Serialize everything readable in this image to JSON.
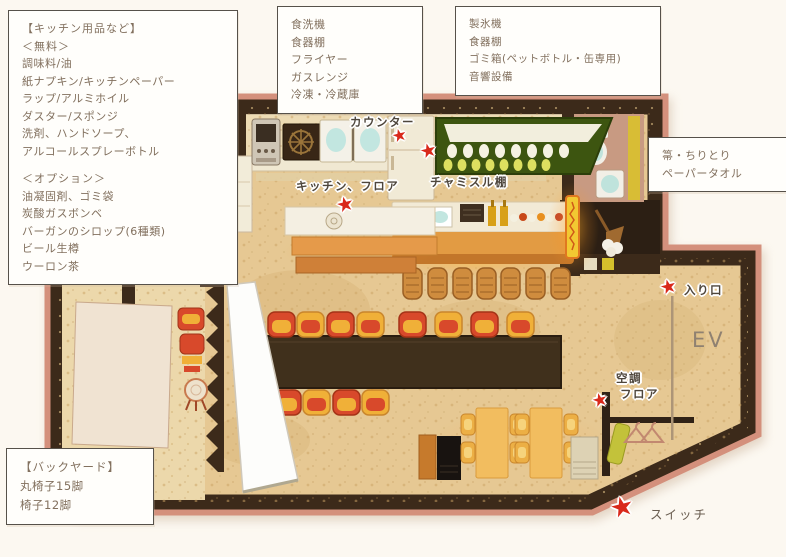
{
  "icons": {
    "star": "★"
  },
  "boxes": {
    "kitchen_supplies": {
      "title": "【キッチン用品など】",
      "free_heading": "＜無料＞",
      "free_items": [
        "調味料/油",
        "紙ナプキン/キッチンペーパー",
        "ラップ/アルミホイル",
        "ダスター/スポンジ",
        "洗剤、ハンドソープ、",
        "アルコールスプレーボトル"
      ],
      "option_heading": "＜オプション＞",
      "option_items": [
        "油凝固剤、ゴミ袋",
        "炭酸ガスボンベ",
        "バーガンのシロップ(6種類)",
        "ビール生樽",
        "ウーロン茶"
      ]
    },
    "equipment_center": {
      "items": [
        "食洗機",
        "食器棚",
        "フライヤー",
        "ガスレンジ",
        "冷凍・冷蔵庫"
      ]
    },
    "equipment_right": {
      "items": [
        "製氷機",
        "食器棚",
        "ゴミ箱(ペットボトル・缶専用)",
        "音響設備"
      ]
    },
    "cleaning": {
      "items": [
        "箒・ちりとり",
        "ペーパータオル"
      ]
    },
    "backyard": {
      "title": "【バックヤード】",
      "items": [
        "丸椅子15脚",
        "椅子12脚"
      ]
    }
  },
  "map_labels": {
    "counter": "カウンター",
    "chamisul_shelf": "チャミスル棚",
    "kitchen_floor": "キッチン、フロア",
    "entrance": "入り口",
    "elevator": "EV",
    "aircon_line1": "空調",
    "aircon_line2": "フロア"
  },
  "legend": {
    "switch_label": "スイッチ"
  },
  "colors": {
    "star-red": "#d9291b",
    "wall-brown": "#3c2a1a",
    "floor-tan": "#e6c893",
    "trim-rose": "#d4907c",
    "chair-red": "#d8492b",
    "chair-yellow": "#f0b038",
    "shelf-green": "#3d5510",
    "neon-yellow": "#f2c832",
    "bar-wood": "#e29b43"
  }
}
